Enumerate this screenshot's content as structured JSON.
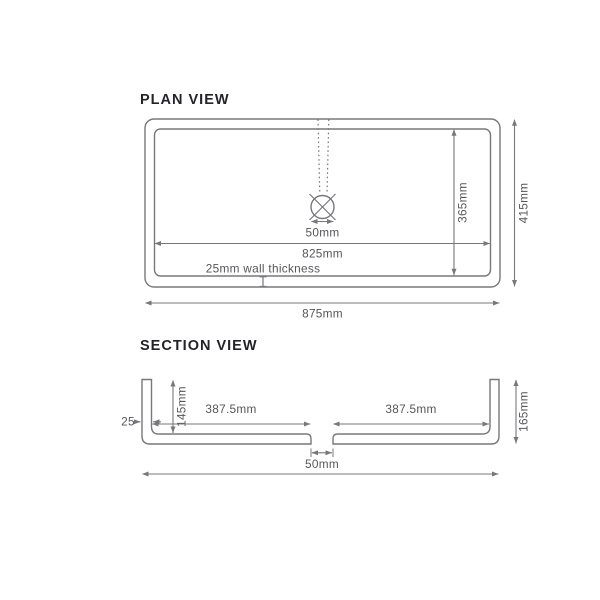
{
  "plan": {
    "title": "PLAN VIEW",
    "dims": {
      "drain_width": "50mm",
      "inner_width": "825mm",
      "wall_thickness_note": "25mm wall thickness",
      "inner_depth": "365mm",
      "overall_depth": "415mm",
      "overall_width": "875mm"
    }
  },
  "section": {
    "title": "SECTION VIEW",
    "dims": {
      "wall_thickness": "25",
      "bowl_depth": "145mm",
      "left_half_width": "387.5mm",
      "right_half_width": "387.5mm",
      "overall_height": "165mm",
      "drain_width": "50mm"
    }
  },
  "icons": {
    "drain_symbol": "circle-with-cross",
    "tap_centerline": "dotted-line"
  },
  "colors": {
    "line": "#77787c",
    "dim": "#77787c",
    "text": "#55565b",
    "title": "#232329"
  }
}
